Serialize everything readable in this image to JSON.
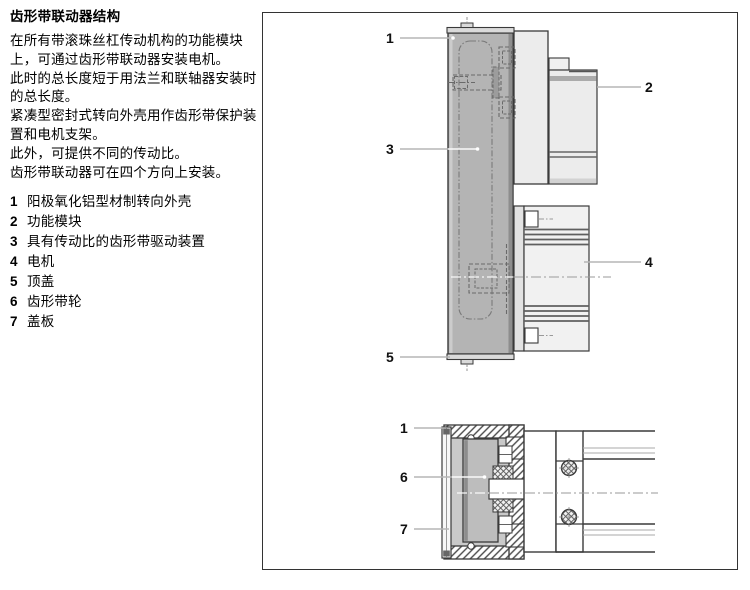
{
  "page": {
    "title": "齿形带联动器结构",
    "paragraph_lines": [
      "在所有带滚珠丝杠传动机构的功能模块",
      "上，可通过齿形带联动器安装电机。",
      "此时的总长度短于用法兰和联轴器安装时",
      "的总长度。",
      "紧凑型密封式转向外壳用作齿形带保护装",
      "置和电机支架。",
      "此外，可提供不同的传动比。",
      "齿形带联动器可在四个方向上安装。"
    ],
    "legend": [
      {
        "num": "1",
        "text": "阳极氧化铝型材制转向外壳"
      },
      {
        "num": "2",
        "text": "功能模块"
      },
      {
        "num": "3",
        "text": "具有传动比的齿形带驱动装置"
      },
      {
        "num": "4",
        "text": "电机"
      },
      {
        "num": "5",
        "text": "顶盖"
      },
      {
        "num": "6",
        "text": "齿形带轮"
      },
      {
        "num": "7",
        "text": "盖板"
      }
    ]
  },
  "figure": {
    "top_callouts": [
      "1",
      "3",
      "5",
      "2",
      "4"
    ],
    "bottom_callouts": [
      "1",
      "6",
      "7"
    ],
    "colors": {
      "housing_gray": "#b4b4b4",
      "panel_light_gray": "#ececec",
      "pulley_gray": "#bdbdbd",
      "outline": "#3a3a3a",
      "leader_line": "#b5b5b5"
    }
  }
}
